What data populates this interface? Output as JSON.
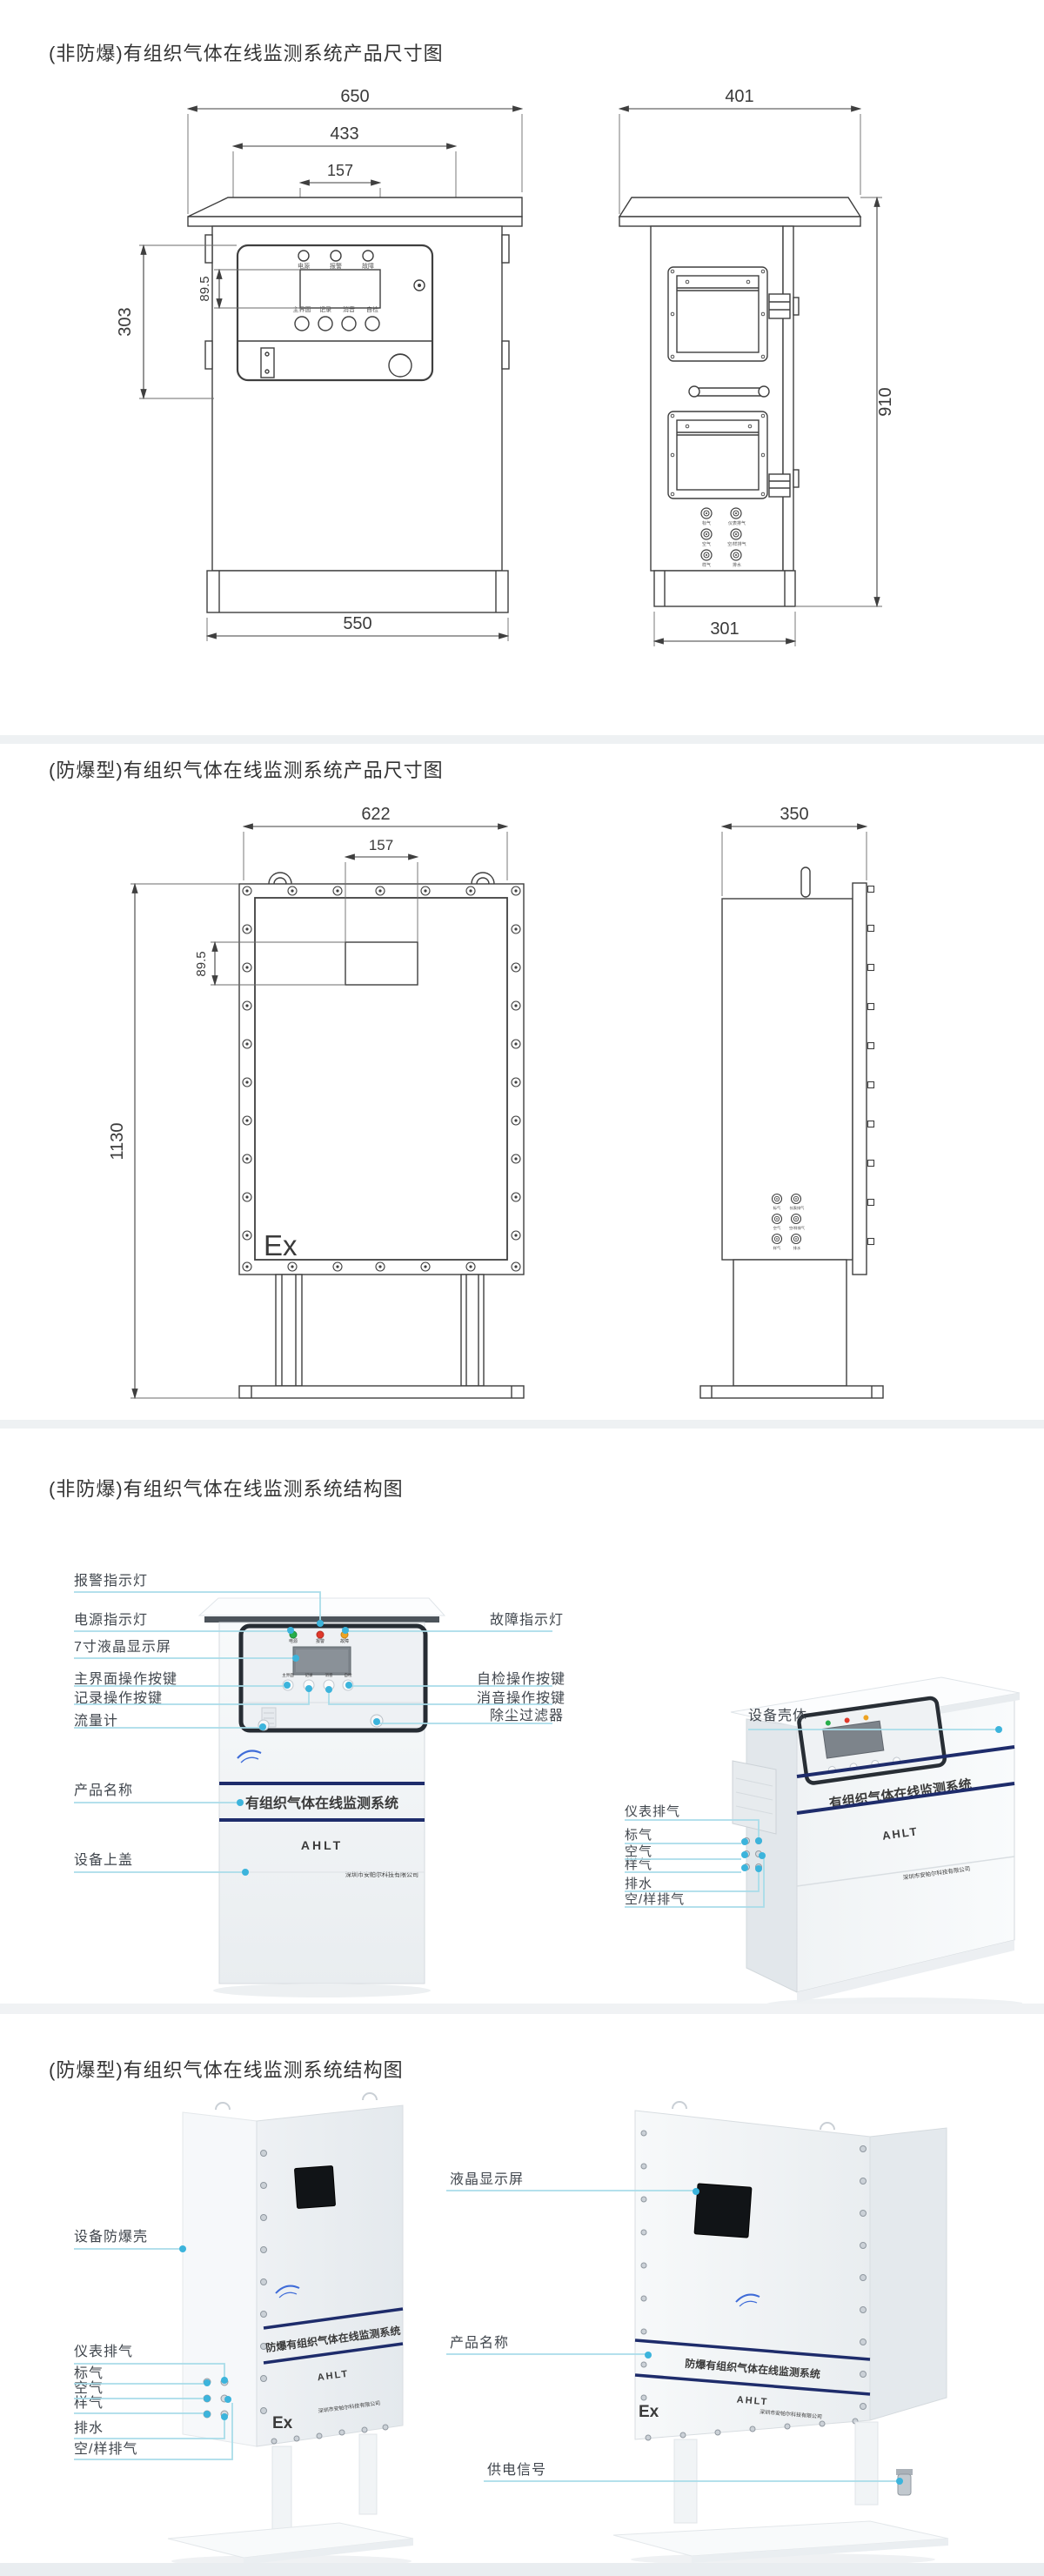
{
  "colors": {
    "leader_line": "#a9dce9",
    "leader_dot": "#3cb4dc",
    "band_navy": "#1e2c6b",
    "ex_red": "#e8251f",
    "drawing_stroke": "#3f3f3f"
  },
  "sections": {
    "dim_nonex": {
      "title": "(非防爆)有组织气体在线监测系统产品尺寸图",
      "front": {
        "dim_roof_width": "650",
        "dim_door_width": "433",
        "dim_screen_width": "157",
        "dim_screen_height": "89.5",
        "dim_door_height": "303",
        "dim_base_width": "550",
        "led_labels": [
          "电源",
          "报警",
          "故障"
        ],
        "button_labels": [
          "主界面",
          "记录",
          "消音",
          "自检"
        ]
      },
      "side": {
        "dim_roof_depth": "401",
        "dim_height": "910",
        "dim_base_depth": "301",
        "port_labels_left": [
          "标气",
          "空气",
          "样气"
        ],
        "port_labels_right": [
          "仪表排气",
          "空/样排气",
          "排水"
        ]
      }
    },
    "dim_ex": {
      "title": "(防爆型)有组织气体在线监测系统产品尺寸图",
      "front": {
        "dim_width": "622",
        "dim_screen_width": "157",
        "dim_screen_height": "89.5",
        "dim_height": "1130",
        "ex_mark": "Ex"
      },
      "side": {
        "dim_depth": "350",
        "port_labels_left": [
          "标气",
          "空气",
          "样气"
        ],
        "port_labels_right": [
          "仪表排气",
          "空/样排气",
          "排水"
        ]
      }
    },
    "struct_nonex": {
      "title": "(非防爆)有组织气体在线监测系统结构图",
      "callouts_left": [
        "报警指示灯",
        "电源指示灯",
        "7寸液晶显示屏",
        "主界面操作按键",
        "记录操作按键",
        "流量计",
        "产品名称",
        "设备上盖"
      ],
      "callouts_right": [
        "故障指示灯",
        "自检操作按键",
        "消音操作按键",
        "除尘过滤器"
      ],
      "callout_housing": "设备壳体",
      "callouts_ports": [
        "仪表排气",
        "标气",
        "空气",
        "样气",
        "排水",
        "空/样排气"
      ],
      "front_unit": {
        "led_labels": [
          "电源",
          "报警",
          "故障"
        ],
        "button_labels": [
          "主界面",
          "记录",
          "消音",
          "自检"
        ],
        "band_text": "有组织气体在线监测系统",
        "brand": "AHLT",
        "company": "深圳市安帕尔科技有限公司"
      },
      "side_unit": {
        "band_text": "有组织气体在线监测系统",
        "brand": "AHLT",
        "company": "深圳市安帕尔科技有限公司"
      }
    },
    "struct_ex": {
      "title": "(防爆型)有组织气体在线监测系统结构图",
      "callouts_left": [
        "设备防爆壳",
        "仪表排气",
        "标气",
        "空气",
        "样气",
        "排水",
        "空/样排气"
      ],
      "callouts_right": [
        "液晶显示屏",
        "产品名称",
        "供电信号"
      ],
      "left_unit": {
        "band_text": "防爆有组织气体在线监测系统",
        "brand": "AHLT",
        "company": "深圳市安帕尔科技有限公司",
        "ex_mark": "Ex"
      },
      "right_unit": {
        "band_text": "防爆有组织气体在线监测系统",
        "brand": "AHLT",
        "company": "深圳市安帕尔科技有限公司",
        "ex_mark": "Ex"
      }
    }
  }
}
